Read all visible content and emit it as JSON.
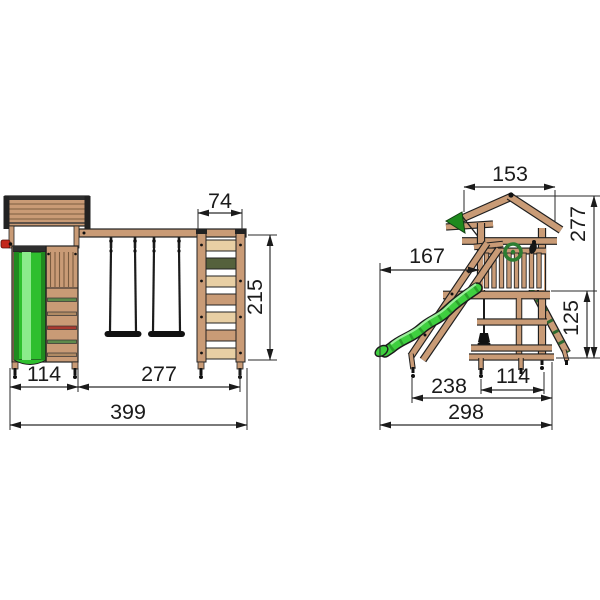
{
  "front_view": {
    "dims": {
      "climbing_frame_width": "74",
      "frame_height": "215",
      "tower_width": "114",
      "swing_section_width": "277",
      "total_width": "399"
    }
  },
  "side_view": {
    "dims": {
      "roof_depth": "153",
      "total_height": "277",
      "slide_reach": "167",
      "platform_height": "125",
      "base_depth_inner": "238",
      "tower_base_depth": "114",
      "total_depth": "298"
    }
  },
  "colors": {
    "wood": "#C99B76",
    "wood_light": "#E8CFA4",
    "slide_green": "#3FCF3F",
    "slide_green_dark": "#1F8A1F",
    "flag_green": "#1E8A1E",
    "steering_wheel_red": "#C3271B",
    "wheel_green": "#2E7D32",
    "line": "#1B1B1B"
  }
}
